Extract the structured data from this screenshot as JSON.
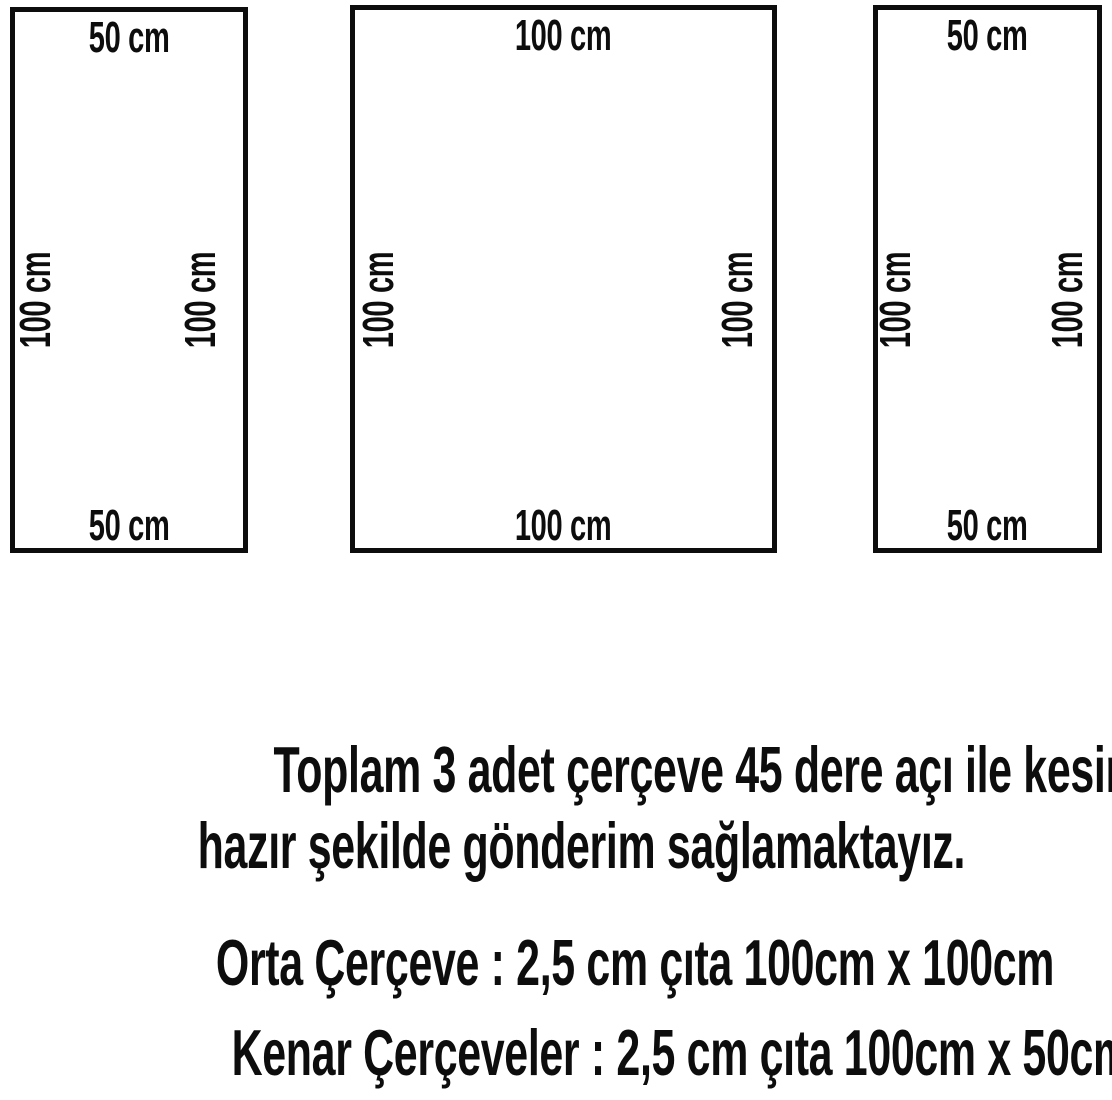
{
  "colors": {
    "ink": "#0d0d0d",
    "background": "#ffffff"
  },
  "frames": [
    {
      "id": "left-side-frame",
      "top_label": "50 cm",
      "bottom_label": "50 cm",
      "left_label": "100 cm",
      "right_label": "100 cm"
    },
    {
      "id": "middle-frame",
      "top_label": "100 cm",
      "bottom_label": "100 cm",
      "left_label": "100 cm",
      "right_label": "100 cm"
    },
    {
      "id": "right-side-frame",
      "top_label": "50 cm",
      "bottom_label": "50 cm",
      "left_label": "100 cm",
      "right_label": "100 cm"
    }
  ],
  "caption": {
    "line1": "Toplam 3 adet çerçeve 45 dere açı ile kesimi yapılmış",
    "line2": "hazır şekilde gönderim sağlamaktayız."
  },
  "specs": [
    {
      "label": "Orta Çerçeve : 2,5 cm çıta 100cm x 100cm"
    },
    {
      "label": "Kenar Çerçeveler : 2,5 cm çıta 100cm x 50cm"
    }
  ]
}
